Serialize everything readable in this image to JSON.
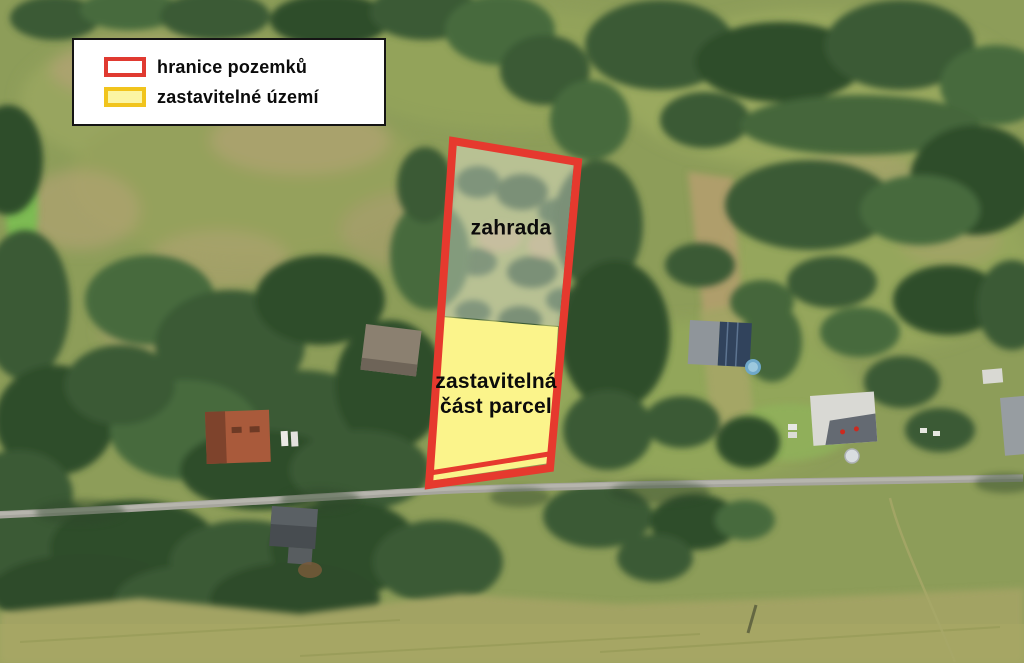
{
  "map": {
    "type": "aerial-parcel-map",
    "parcel": {
      "zahrada_label": "zahrada",
      "buildable_label_line1": "zastavitelná",
      "buildable_label_line2": "část parcel"
    },
    "legend": {
      "items": [
        {
          "label": "hranice pozemků",
          "swatch": "parcel-boundary-red-outline"
        },
        {
          "label": "zastavitelné území",
          "swatch": "buildable-area-yellow-fill"
        }
      ]
    }
  },
  "colors": {
    "boundary_red": "#e6392e",
    "zone_yellow": "#fbf48b",
    "zahrada_overlay": "rgba(255,255,255,0.33)",
    "legend_red_border": "#e03a31",
    "legend_yellow_border": "#f1c41d",
    "legend_yellow_fill": "#fbf5a3",
    "label_text": "#0b0b0b"
  }
}
